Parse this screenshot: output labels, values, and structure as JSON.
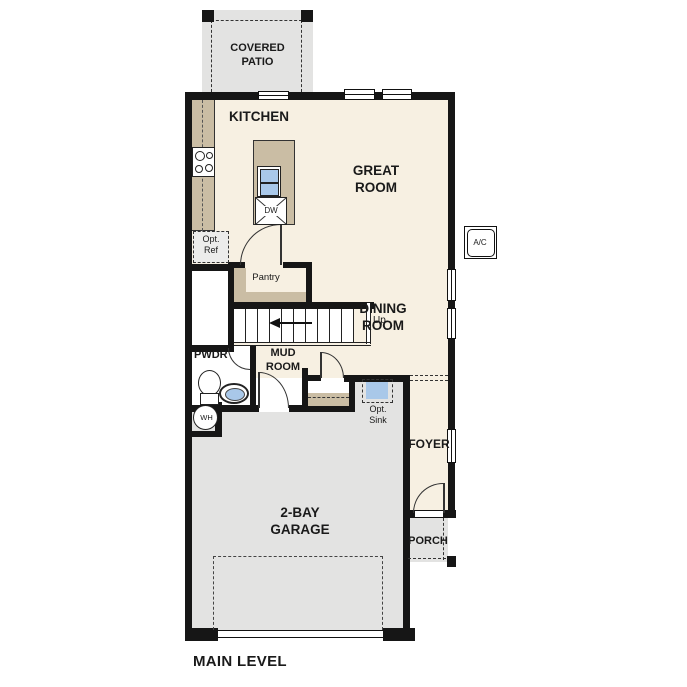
{
  "type": "residential-floor-plan",
  "title": "MAIN LEVEL",
  "labels": {
    "covered_patio": "COVERED\nPATIO",
    "kitchen": "KITCHEN",
    "great_room": "GREAT\nROOM",
    "dining_room": "DINING\nROOM",
    "pantry": "Pantry",
    "up": "Up",
    "pwdr": "PWDR",
    "mud_room": "MUD\nROOM",
    "opt_ref": "Opt.\nRef",
    "opt_sink": "Opt.\nSink",
    "dw": "DW",
    "ac": "A/C",
    "wh": "WH",
    "garage": "2-BAY\nGARAGE",
    "foyer": "FOYER",
    "porch": "PORCH",
    "main_level": "MAIN LEVEL"
  },
  "colors": {
    "floor_cream": "#f7f0e2",
    "counter_tan": "#cabda4",
    "concrete_gray": "#e3e3e2",
    "fixture_blue": "#a9c8e9",
    "wall_black": "#161616"
  }
}
